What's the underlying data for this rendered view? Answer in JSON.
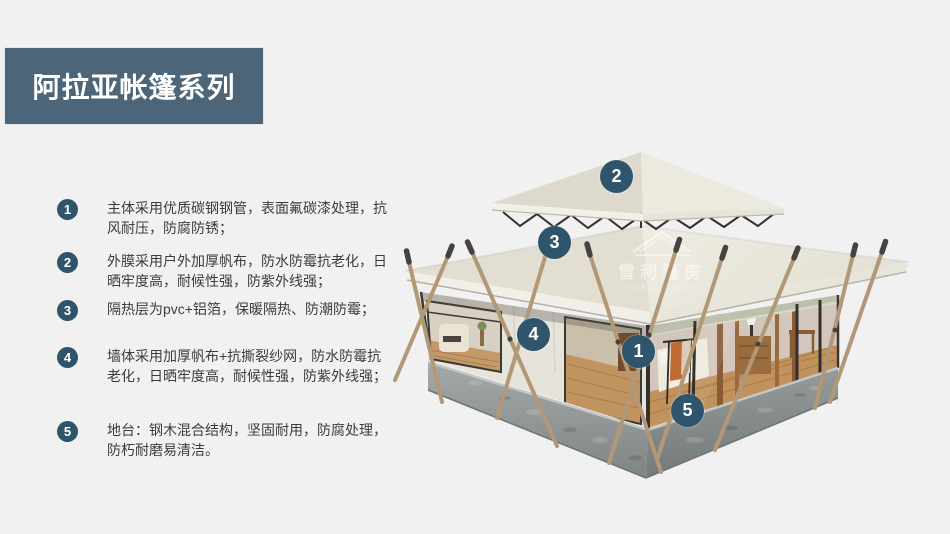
{
  "banner": {
    "title": "阿拉亚帐篷系列",
    "bg_color": "#4d6578",
    "text_color": "#ffffff"
  },
  "features": [
    {
      "num": "1",
      "text": "主体采用优质碳钢钢管，表面氟碳漆处理，抗风耐压，防腐防锈；"
    },
    {
      "num": "2",
      "text": "外膜采用户外加厚帆布，防水防霉抗老化，日晒牢度高，耐候性强，防紫外线强；"
    },
    {
      "num": "3",
      "text": "隔热层为pvc+铝箔，保暖隔热、防潮防霉；"
    },
    {
      "num": "4",
      "text": "墙体采用加厚帆布+抗撕裂纱网，防水防霉抗老化，日晒牢度高，耐候性强，防紫外线强；"
    },
    {
      "num": "5",
      "text": "地台：钢木混合结构，坚固耐用，防腐处理，防朽耐磨易清洁。"
    }
  ],
  "tent": {
    "callouts": [
      {
        "num": "2"
      },
      {
        "num": "3"
      },
      {
        "num": "4"
      },
      {
        "num": "1"
      },
      {
        "num": "5"
      }
    ],
    "badge_color": "#2e556b"
  },
  "watermark": {
    "cn": "雪利篷房",
    "en": "YUELI TENT"
  },
  "colors": {
    "page_background": "#f1f1f2",
    "roof_canvas": "#eae7dc",
    "concrete_base": "#8f9694",
    "wood_pole": "#b39877",
    "wood_floor": "#c2925c"
  }
}
